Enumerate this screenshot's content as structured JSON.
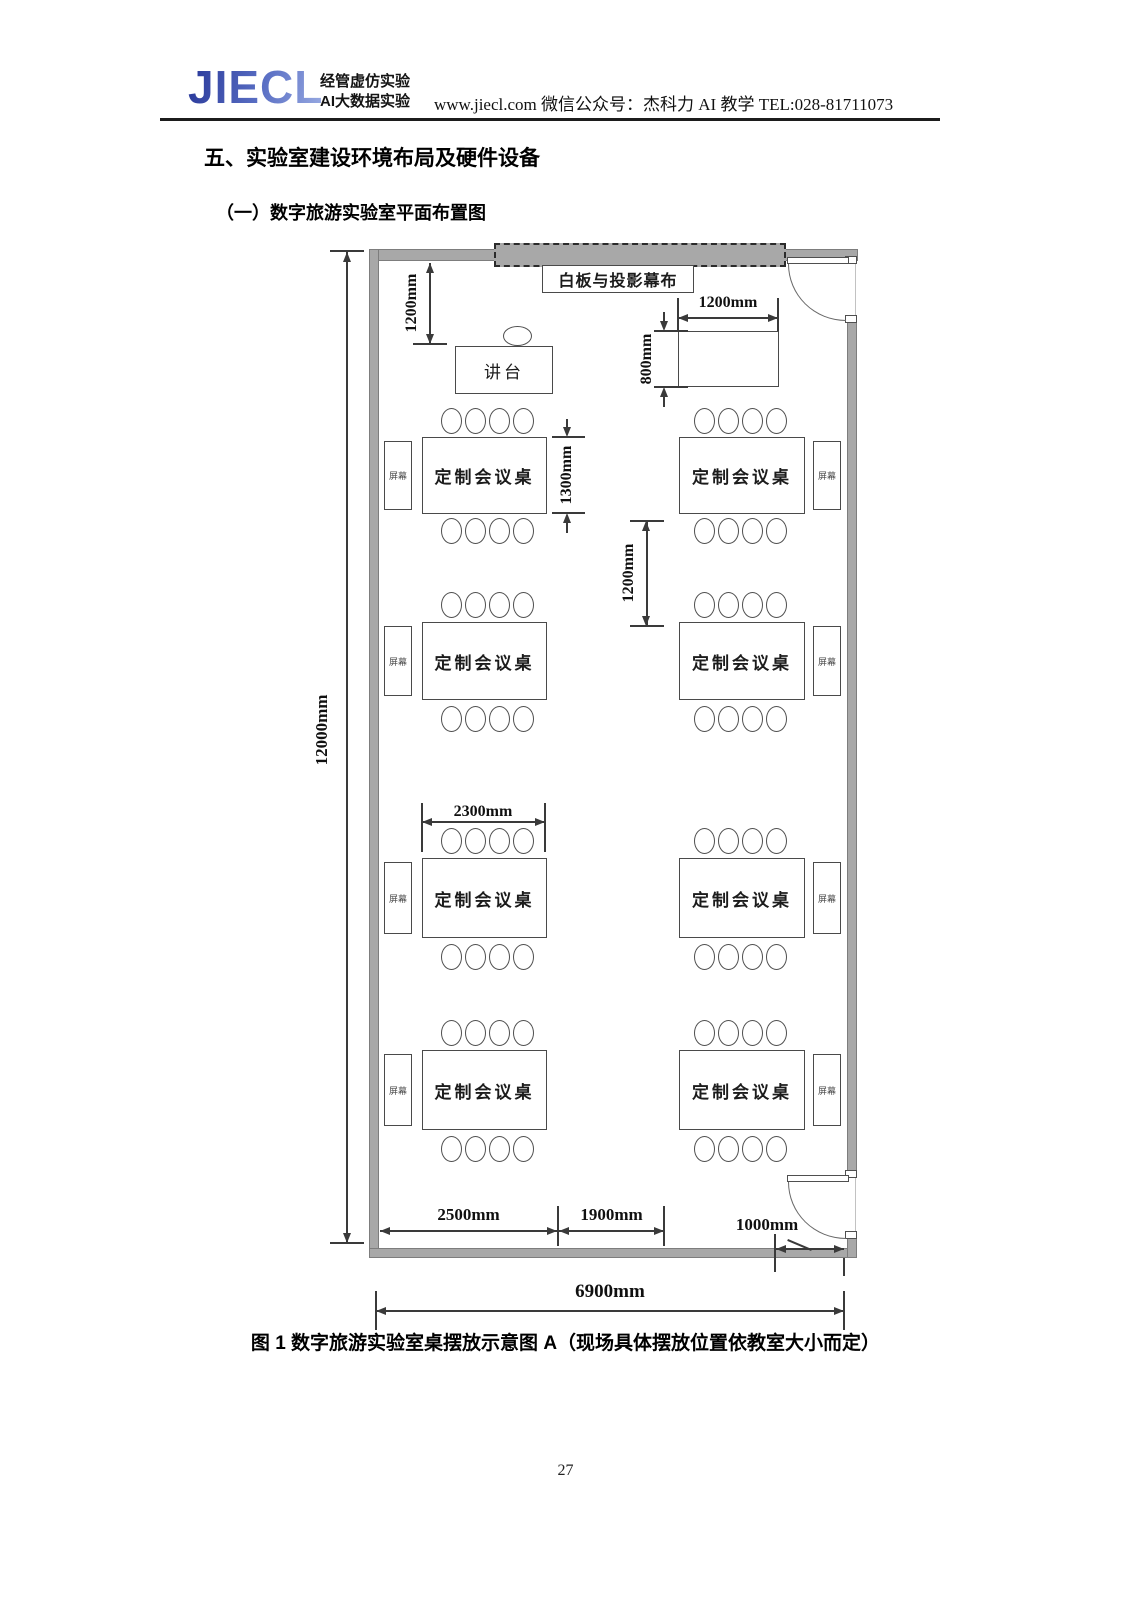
{
  "header": {
    "logo_text": "JIECL",
    "logo_sub1": "经管虚仿实验",
    "logo_sub2": "AI大数据实验",
    "contact": "www.jiecl.com  微信公众号：杰科力 AI 教学    TEL:028-81711073"
  },
  "section": {
    "title": "五、实验室建设环境布局及硬件设备",
    "subtitle": "（一）数字旅游实验室平面布置图"
  },
  "diagram": {
    "whiteboard_label": "白板与投影幕布",
    "podium_label": "讲台",
    "table_label": "定制会议桌",
    "screen_label": "屏幕",
    "dims": {
      "room_depth": "12000mm",
      "front_offset": "1200mm",
      "side_table_width": "1200mm",
      "side_table_depth": "800mm",
      "table_depth": "1300mm",
      "row_gap": "1200mm",
      "table_width": "2300mm",
      "aisle_left": "2500mm",
      "aisle_mid": "1900mm",
      "door_offset": "1000mm",
      "room_width": "6900mm"
    }
  },
  "caption": "图 1 数字旅游实验室桌摆放示意图 A（现场具体摆放位置依教室大小而定）",
  "page": {
    "number": "27"
  }
}
